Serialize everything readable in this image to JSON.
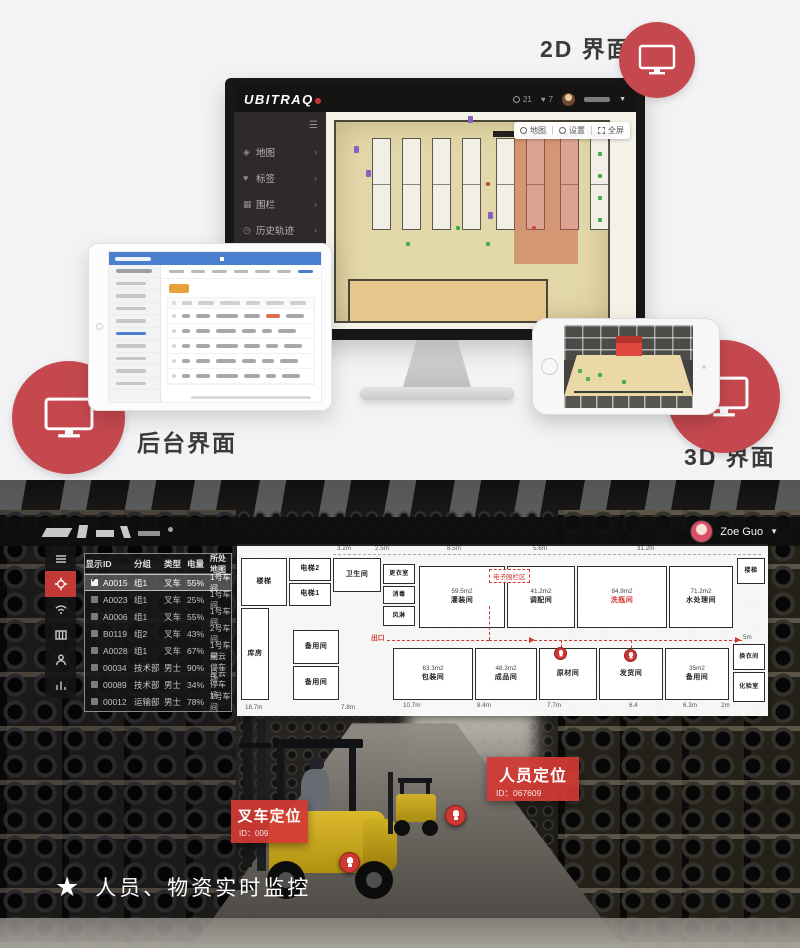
{
  "colors": {
    "accent_red": "#c6484f",
    "badge_red": "#d23a34"
  },
  "top": {
    "labels": {
      "two_d": "2D 界面",
      "backend": "后台界面",
      "three_d": "3D 界面"
    },
    "monitor": {
      "logo": "UBITRAQ",
      "badge_count_1": "21",
      "badge_count_2": "7",
      "menu": [
        {
          "icon": "map-icon",
          "glyph": "◈",
          "label": "地图"
        },
        {
          "icon": "tag-icon",
          "glyph": "♥",
          "label": "标签"
        },
        {
          "icon": "fence-icon",
          "glyph": "▦",
          "label": "围栏"
        },
        {
          "icon": "history-icon",
          "glyph": "◷",
          "label": "历史轨迹"
        }
      ],
      "map_toolbar": [
        {
          "label": "地图"
        },
        {
          "label": "设置"
        },
        {
          "label": "全屏"
        }
      ]
    }
  },
  "bottom": {
    "topbar": {
      "user": "Zoe Guo"
    },
    "table": {
      "headers": [
        "显示",
        "ID",
        "分组",
        "类型",
        "电量",
        "所处地图"
      ],
      "rows": [
        {
          "checked": true,
          "id": "A0015",
          "group": "组1",
          "type": "叉车",
          "battery": "55%",
          "map": "1号车间"
        },
        {
          "checked": false,
          "id": "A0023",
          "group": "组1",
          "type": "叉车",
          "battery": "25%",
          "map": "1号车间"
        },
        {
          "checked": false,
          "id": "A0006",
          "group": "组1",
          "type": "叉车",
          "battery": "55%",
          "map": "1号车间"
        },
        {
          "checked": false,
          "id": "B0119",
          "group": "组2",
          "type": "叉车",
          "battery": "43%",
          "map": "2号车间"
        },
        {
          "checked": false,
          "id": "A0028",
          "group": "组1",
          "type": "叉车",
          "battery": "67%",
          "map": "1号车间"
        },
        {
          "checked": false,
          "id": "00034",
          "group": "技术部",
          "type": "男士",
          "battery": "90%",
          "map": "星云停车场"
        },
        {
          "checked": false,
          "id": "00089",
          "group": "技术部",
          "type": "男士",
          "battery": "34%",
          "map": "星云停车场"
        },
        {
          "checked": false,
          "id": "00012",
          "group": "运输部",
          "type": "男士",
          "battery": "78%",
          "map": "1号车间"
        }
      ]
    },
    "floorplan": {
      "rooms": {
        "stairs_left": "楼梯",
        "elevator2": "电梯2",
        "elevator1": "电梯1",
        "toilet": "卫生间",
        "locker": "更衣室",
        "disinfect": "消毒",
        "air_shower": "风淋",
        "filling": {
          "area": "59.5m2",
          "name": "灌装间"
        },
        "blending": {
          "area": "41.2m2",
          "name": "调配间"
        },
        "washing": {
          "area": "84.9m2",
          "name": "洗瓶间"
        },
        "water": {
          "area": "71.2m2",
          "name": "水处理间"
        },
        "stairs_right": "楼梯",
        "storage": "库房",
        "spare_a": "备用间",
        "spare_b": "备用间",
        "packing": {
          "area": "63.3m2",
          "name": "包装间"
        },
        "finished": {
          "area": "48.3m2",
          "name": "成品间"
        },
        "raw": "原材间",
        "shipping": "发货间",
        "spare_c": {
          "area": "35m2",
          "name": "备用间"
        },
        "changing": "换衣间",
        "lab": "化验室"
      },
      "red_labels": {
        "fence": "电子围栏区",
        "exit": "出口"
      },
      "dims": [
        "3.2m",
        "2.5m",
        "8.5m",
        "5.6m",
        "31.2m",
        "5m",
        "10.7m",
        "8.4m",
        "7.7m",
        "6.4",
        "6.3m",
        "2m",
        "18.7m",
        "7.8m"
      ]
    },
    "badges": {
      "person": {
        "title": "人员定位",
        "id": "ID：067609"
      },
      "forklift": {
        "title": "叉车定位",
        "id": "ID：009"
      }
    },
    "caption": "人员、物资实时监控"
  }
}
